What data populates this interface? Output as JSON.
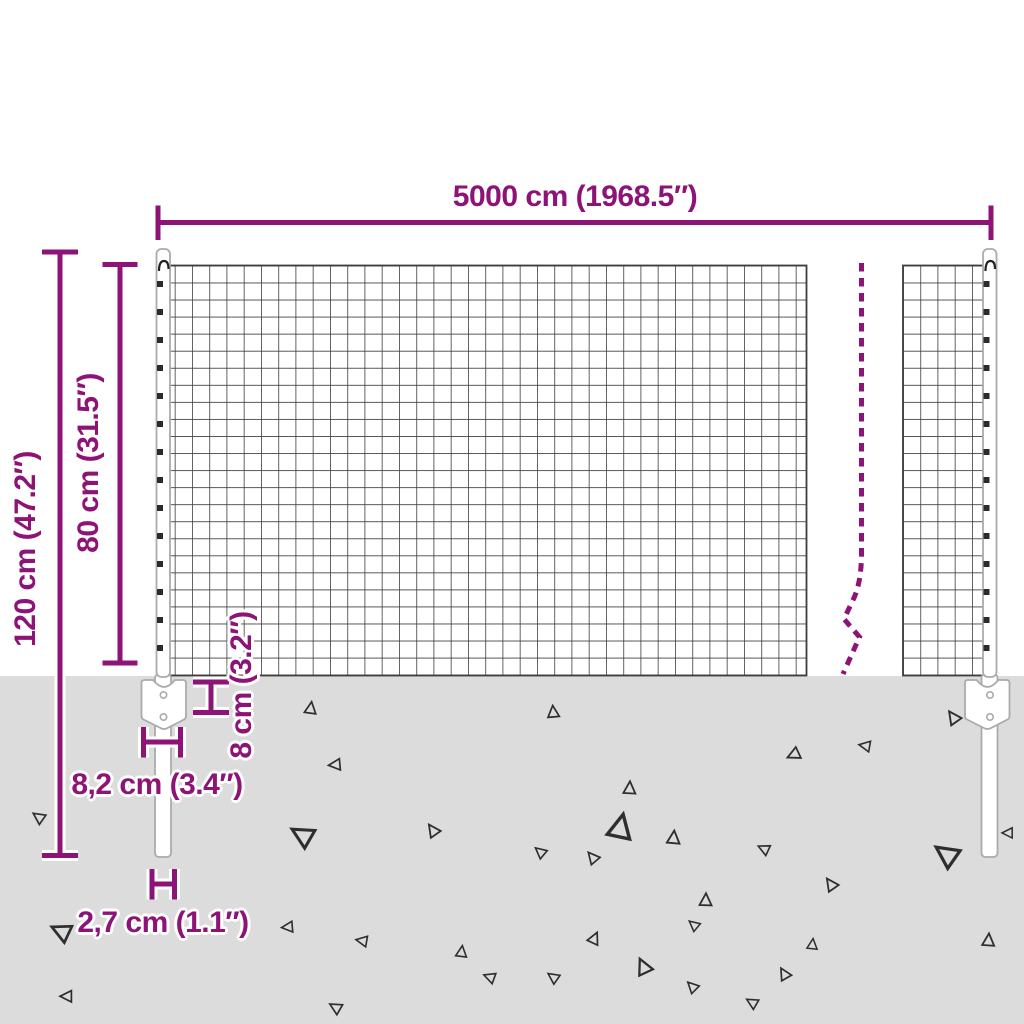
{
  "title": "Wire mesh fence dimension diagram",
  "colors": {
    "accent": "#8d1377",
    "ground": "#dcdcdc",
    "mesh_line": "#3d3d3d",
    "post_outline": "#ababab"
  },
  "dimensions": {
    "total_width": "5000 cm (1968.5″)",
    "total_height": "120 cm (47.2″)",
    "mesh_height": "80 cm (31.5″)",
    "anchor_height": "8 cm (3.2″)",
    "anchor_width": "8,2 cm (3.4″)",
    "post_width": "2,7 cm (1.1″)"
  }
}
